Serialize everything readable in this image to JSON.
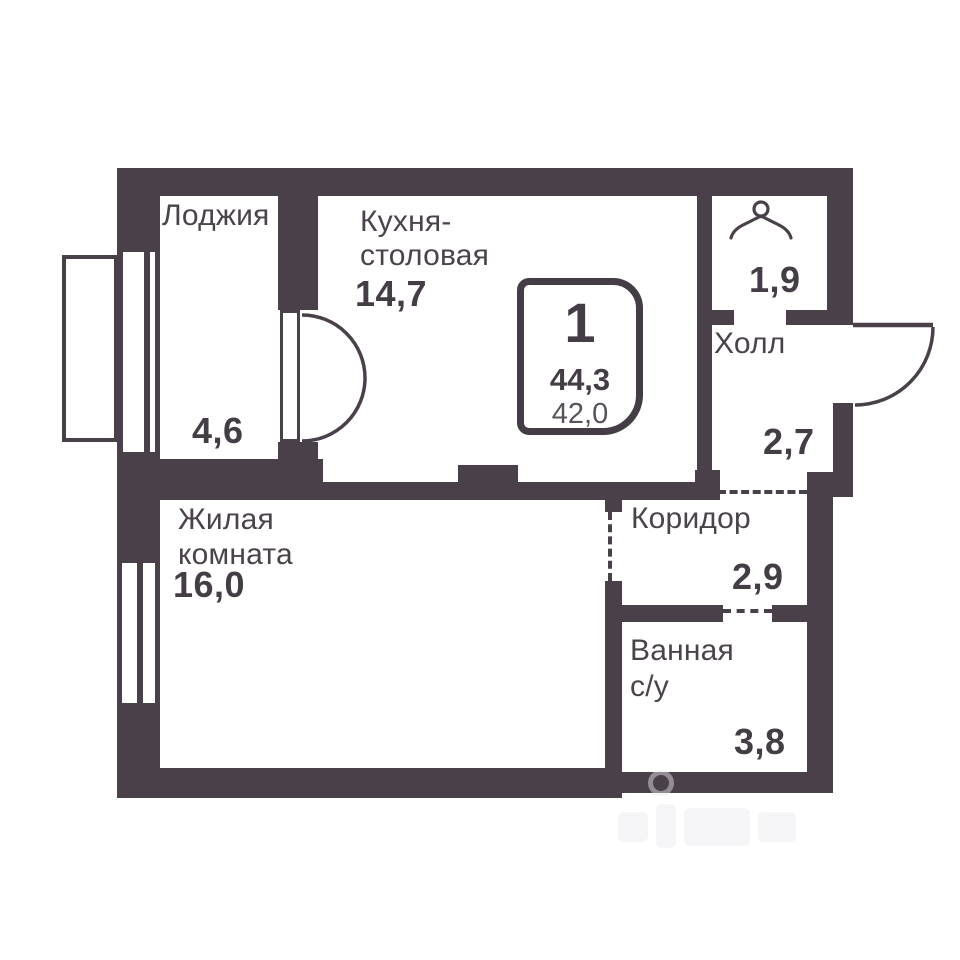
{
  "colors": {
    "wall": "#494049",
    "text": "#4b434b",
    "text_strong": "#453d46",
    "text_muted": "#58525b",
    "background": "#ffffff",
    "watermark": "#efedf1"
  },
  "badge": {
    "room_count": "1",
    "total_area": "44,3",
    "living_area": "42,0"
  },
  "rooms": {
    "loggia": {
      "label": "Лоджия",
      "area": "4,6"
    },
    "kitchen": {
      "label_line1": "Кухня-",
      "label_line2": "столовая",
      "area": "14,7"
    },
    "wardrobe": {
      "area": "1,9"
    },
    "hall": {
      "label": "Холл",
      "area": "2,7"
    },
    "corridor": {
      "label": "Коридор",
      "area": "2,9"
    },
    "bathroom": {
      "label_line1": "Ванная",
      "label_line2": "с/у",
      "area": "3,8"
    },
    "living_room": {
      "label_line1": "Жилая",
      "label_line2": "комната",
      "area": "16,0"
    }
  },
  "icons": {
    "wardrobe": "hanger-icon",
    "doors": [
      "balcony-double-door-swing",
      "entrance-door-swing"
    ]
  }
}
